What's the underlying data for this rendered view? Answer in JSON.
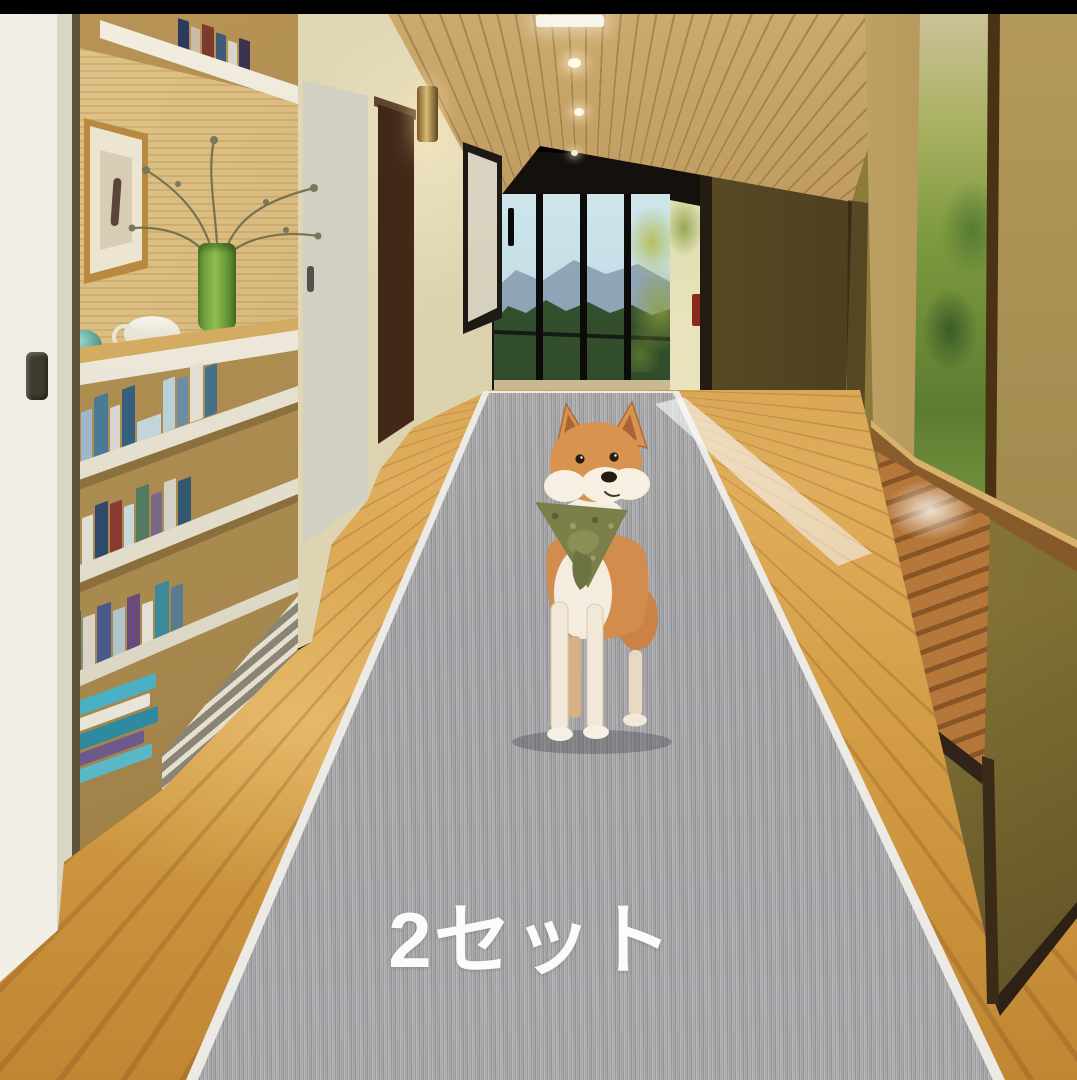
{
  "caption": {
    "text": "2セット",
    "color": "#fafafa"
  },
  "scene": {
    "subject": "shiba-inu-dog-with-olive-bandana",
    "product": "gray-carpet-runner-on-hallway-floor",
    "setting": "modern-wood-hallway-with-bookshelf-glass-door-mountain-view"
  },
  "palette": {
    "letterbox": "#000000",
    "carpet_gray": "#a9a8ab",
    "carpet_binding": "#eceae4",
    "floor_wood": "#d29b43",
    "ceiling_wood": "#a5814a",
    "left_wall_cream": "#d8cda8",
    "right_wall_olive": "#77682e",
    "end_door_frame": "#17130e",
    "sky_view": "#bcd9e2",
    "mountain_view": "#8a9cb0",
    "hills_view": "#2d4a2a",
    "dog_coat": "#d28c4e",
    "dog_white": "#f5eee1",
    "bandana_olive": "#7b8049",
    "shelf_white": "#efe9da",
    "vase_green": "#6fa23c"
  }
}
